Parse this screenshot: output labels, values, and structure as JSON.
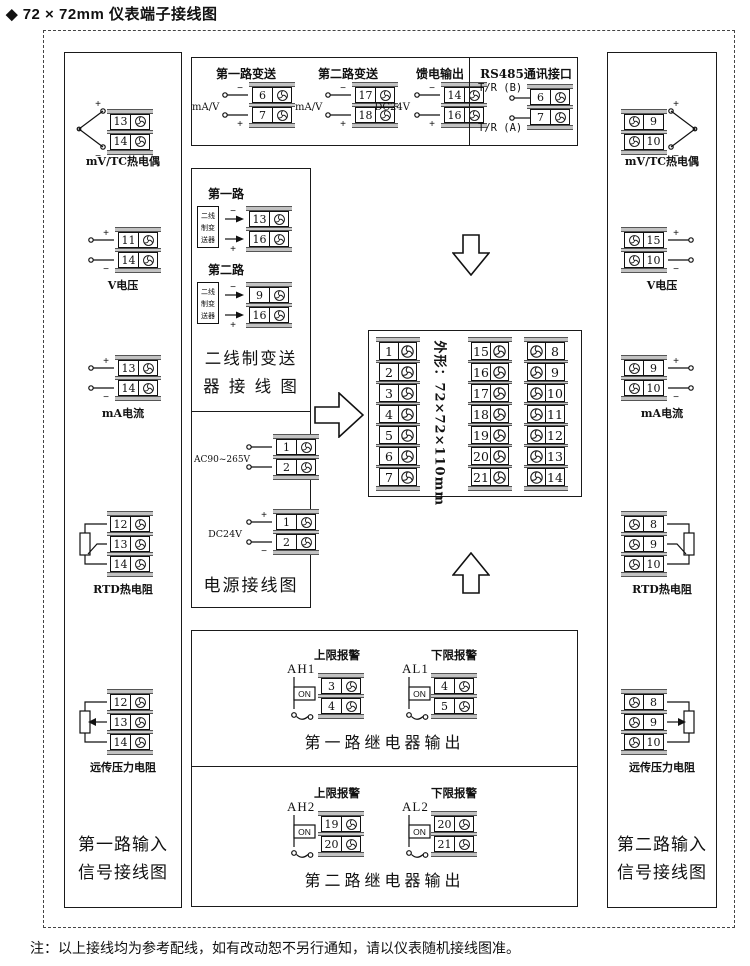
{
  "page": {
    "title": "◆ 72 × 72mm 仪表端子接线图",
    "note": "注：以上接线均为参考配线，如有改动恕不另行通知，请以仪表随机接线图准。"
  },
  "colors": {
    "cap_gray": "#c2c2c2",
    "line": "#1a1a1a",
    "background": "#ffffff"
  },
  "left_box": {
    "title_line1": "第一路输入",
    "title_line2": "信号接线图",
    "sections": [
      {
        "label": "mV/TC热电偶",
        "terminals": [
          {
            "n": "13",
            "sign": "+"
          },
          {
            "n": "14",
            "sign": "−"
          }
        ]
      },
      {
        "label": "V电压",
        "terminals": [
          {
            "n": "11",
            "sign": "+"
          },
          {
            "n": "14",
            "sign": "−"
          }
        ]
      },
      {
        "label": "mA电流",
        "terminals": [
          {
            "n": "13",
            "sign": "+"
          },
          {
            "n": "14",
            "sign": "−"
          }
        ]
      },
      {
        "label": "RTD热电阻",
        "terminals": [
          {
            "n": "12"
          },
          {
            "n": "13"
          },
          {
            "n": "14"
          }
        ]
      },
      {
        "label": "远传压力电阻",
        "terminals": [
          {
            "n": "12"
          },
          {
            "n": "13"
          },
          {
            "n": "14"
          }
        ]
      }
    ]
  },
  "right_box": {
    "title_line1": "第二路输入",
    "title_line2": "信号接线图",
    "sections": [
      {
        "label": "mV/TC热电偶",
        "terminals": [
          {
            "n": "9",
            "sign": "+"
          },
          {
            "n": "10",
            "sign": "−"
          }
        ]
      },
      {
        "label": "V电压",
        "terminals": [
          {
            "n": "15",
            "sign": "+"
          },
          {
            "n": "10",
            "sign": "−"
          }
        ]
      },
      {
        "label": "mA电流",
        "terminals": [
          {
            "n": "9",
            "sign": "+"
          },
          {
            "n": "10",
            "sign": "−"
          }
        ]
      },
      {
        "label": "RTD热电阻",
        "terminals": [
          {
            "n": "8"
          },
          {
            "n": "9"
          },
          {
            "n": "10"
          }
        ]
      },
      {
        "label": "远传压力电阻",
        "terminals": [
          {
            "n": "8"
          },
          {
            "n": "9"
          },
          {
            "n": "10"
          }
        ]
      }
    ]
  },
  "top_box": {
    "groups": [
      {
        "label": "第一路变送",
        "side_label": "mA/V",
        "terminals": [
          {
            "n": "6",
            "sign": "−"
          },
          {
            "n": "7",
            "sign": "+"
          }
        ]
      },
      {
        "label": "第二路变送",
        "side_label": "mA/V",
        "terminals": [
          {
            "n": "17",
            "sign": "−"
          },
          {
            "n": "18",
            "sign": "+"
          }
        ]
      },
      {
        "label": "馈电输出",
        "side_label": "DC24V",
        "terminals": [
          {
            "n": "14",
            "sign": "−"
          },
          {
            "n": "16",
            "sign": "+"
          }
        ]
      }
    ],
    "rs485": {
      "label": "RS485通讯接口",
      "line_b": "T/R (B)",
      "line_a": "T/R (A)",
      "terminals": [
        {
          "n": "6"
        },
        {
          "n": "7"
        }
      ]
    }
  },
  "transmitter_box": {
    "title_line1": "二线制变送",
    "title_line2": "器 接 线 图",
    "groups": [
      {
        "label": "第一路",
        "device_line1": "二线",
        "device_line2": "制变",
        "device_line3": "送器",
        "terminals": [
          {
            "n": "13",
            "sign": "−"
          },
          {
            "n": "16",
            "sign": "+"
          }
        ]
      },
      {
        "label": "第二路",
        "device_line1": "二线",
        "device_line2": "制变",
        "device_line3": "送器",
        "terminals": [
          {
            "n": "9",
            "sign": "−"
          },
          {
            "n": "16",
            "sign": "+"
          }
        ]
      }
    ]
  },
  "power_box": {
    "title": "电源接线图",
    "groups": [
      {
        "side_label": "AC90~265V",
        "terminals": [
          {
            "n": "1"
          },
          {
            "n": "2"
          }
        ]
      },
      {
        "side_label": "DC24V",
        "terminals": [
          {
            "n": "1",
            "sign": "+"
          },
          {
            "n": "2",
            "sign": "−"
          }
        ]
      }
    ]
  },
  "center_box": {
    "size_label": "外形：72×72×110mm",
    "columns": [
      {
        "screw_side": "right",
        "terminals": [
          {
            "n": "1"
          },
          {
            "n": "2"
          },
          {
            "n": "3"
          },
          {
            "n": "4"
          },
          {
            "n": "5"
          },
          {
            "n": "6"
          },
          {
            "n": "7"
          }
        ]
      },
      {
        "screw_side": "right",
        "terminals": [
          {
            "n": "15"
          },
          {
            "n": "16"
          },
          {
            "n": "17"
          },
          {
            "n": "18"
          },
          {
            "n": "19"
          },
          {
            "n": "20"
          },
          {
            "n": "21"
          }
        ]
      },
      {
        "screw_side": "left",
        "terminals": [
          {
            "n": "8"
          },
          {
            "n": "9"
          },
          {
            "n": "10"
          },
          {
            "n": "11"
          },
          {
            "n": "12"
          },
          {
            "n": "13"
          },
          {
            "n": "14"
          }
        ]
      }
    ]
  },
  "relay_boxes": [
    {
      "title": "第一路继电器输出",
      "groups": [
        {
          "header": "上限报警",
          "tag": "AH1",
          "switch_label": "ON",
          "terminals": [
            {
              "n": "3"
            },
            {
              "n": "4"
            }
          ]
        },
        {
          "header": "下限报警",
          "tag": "AL1",
          "switch_label": "ON",
          "terminals": [
            {
              "n": "4"
            },
            {
              "n": "5"
            }
          ]
        }
      ]
    },
    {
      "title": "第二路继电器输出",
      "groups": [
        {
          "header": "上限报警",
          "tag": "AH2",
          "switch_label": "ON",
          "terminals": [
            {
              "n": "19"
            },
            {
              "n": "20"
            }
          ]
        },
        {
          "header": "下限报警",
          "tag": "AL2",
          "switch_label": "ON",
          "terminals": [
            {
              "n": "20"
            },
            {
              "n": "21"
            }
          ]
        }
      ]
    }
  ]
}
